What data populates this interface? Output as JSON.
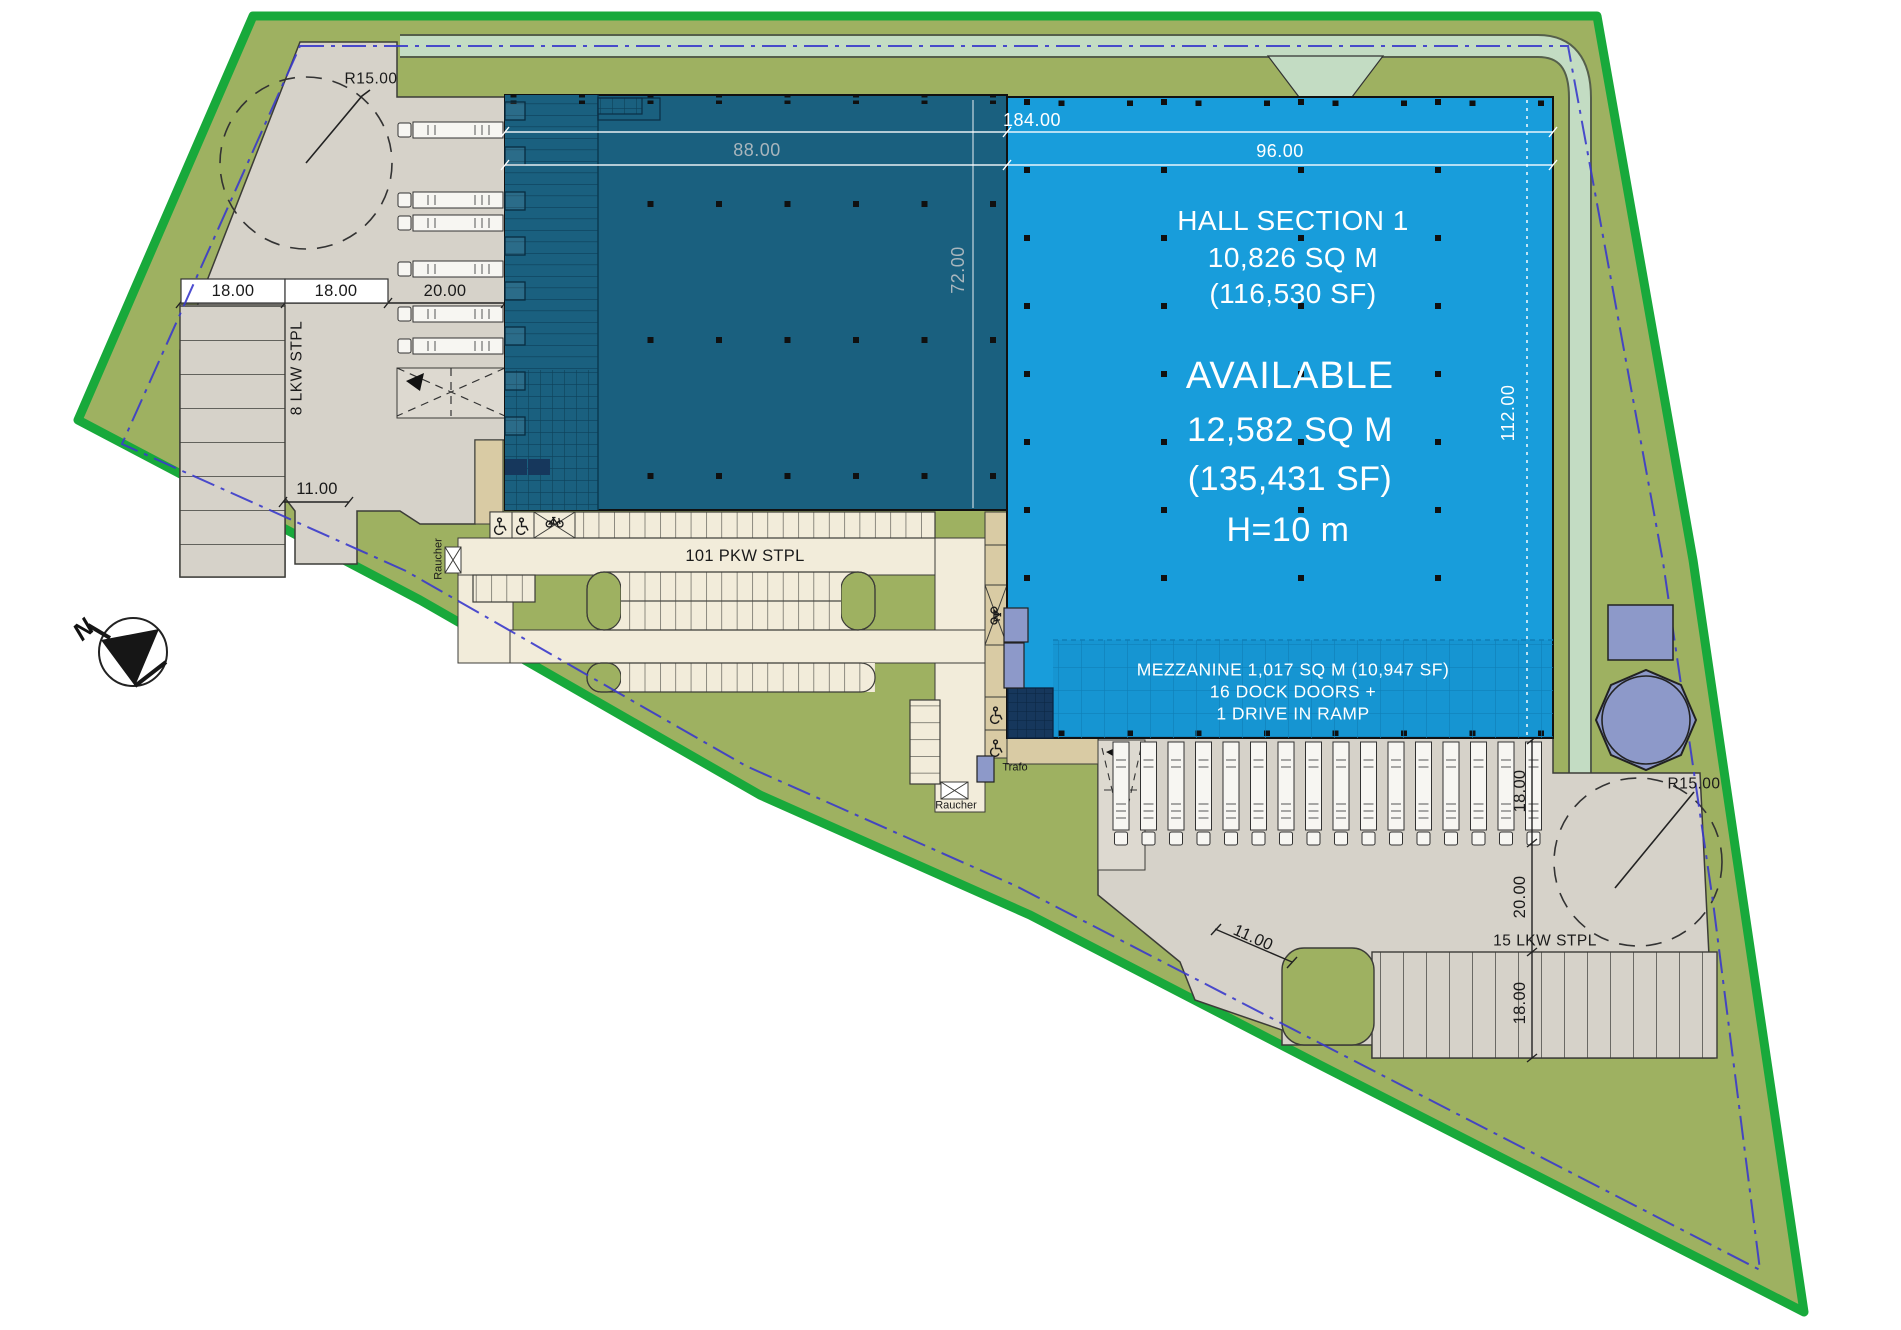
{
  "hall": {
    "name": "HALL SECTION 1",
    "area_sqm": "10,826 SQ M",
    "area_sf": "(116,530 SF)",
    "status": "AVAILABLE",
    "available_sqm": "12,582 SQ M",
    "available_sf": "(135,431 SF)",
    "clear_height": "H=10 m",
    "mezzanine": {
      "line1": "MEZZANINE 1,017 SQ M (10,947 SF)",
      "line2": "16 DOCK DOORS +",
      "line3": "1 DRIVE IN RAMP"
    }
  },
  "dimensions": {
    "total_width_m": "184.00",
    "let_hall_width_m": "88.00",
    "available_hall_width_m": "96.00",
    "let_hall_depth_m": "72.00",
    "available_hall_depth_m": "112.00",
    "nw_stall": "18.00",
    "nw_aisle": "18.00",
    "nw_apron": "20.00",
    "nw_gate": "11.00",
    "se_apron": "18.00",
    "se_aisle": "20.00",
    "se_stall": "18.00",
    "se_gate": "11.00",
    "turning_radius_nw": "R15.00",
    "turning_radius_se": "R15.00"
  },
  "labels": {
    "truck_parking_west": "8 LKW STPL",
    "car_parking": "101 PKW STPL",
    "truck_parking_south": "15 LKW STPL",
    "transformer": "Trafo",
    "smoking_area_west": "Raucher",
    "smoking_area_south": "Raucher",
    "north_indicator": "N"
  },
  "colors": {
    "site_boundary": "#18A93B",
    "grass": "#9EB161",
    "swale": "#C3DCC3",
    "hall_available": "#189DDB",
    "hall_let": "#1A607F",
    "parking_asphalt": "#F2ECDA",
    "yard_concrete": "#D6D2C9",
    "walkway": "#D9CBA4",
    "water_feature": "#8D99C9",
    "office_block": "#16375C",
    "setback_line": "#3A3ACB"
  }
}
